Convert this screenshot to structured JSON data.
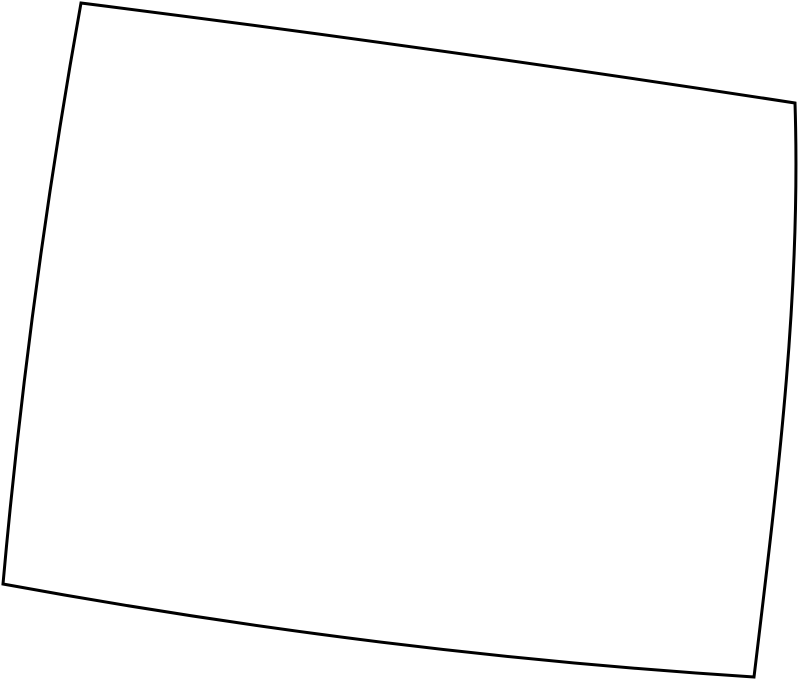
{
  "page": {
    "background_color": "#ffffff",
    "width_px": 800,
    "height_px": 683
  },
  "map": {
    "type": "blank-outline-map",
    "region": "Colorado",
    "description": "Blank state boundary outline, rotated/curved as in an Albers-style projection, no labels or text",
    "outline": {
      "path": "M 81,3 Q 438,48 795,103 C 801,290 779,470 754,677 Q 378,653 3,584 Q 29,293 81,3 Z",
      "stroke_color": "#000000",
      "stroke_width": 3,
      "fill_color": "#ffffff"
    }
  }
}
